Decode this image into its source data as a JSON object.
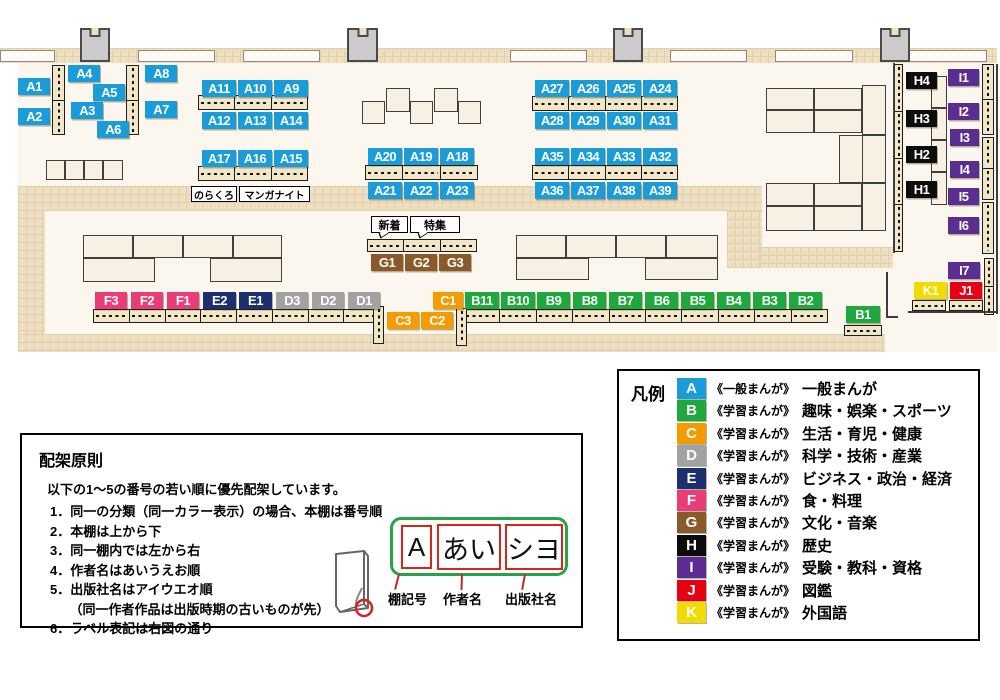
{
  "palette": {
    "A": "#1a9cd8",
    "B": "#1fa83d",
    "C": "#f49b00",
    "D": "#a2a2a2",
    "E": "#1c2f6e",
    "F": "#e83d77",
    "G": "#8b5a2b",
    "H": "#0c0c0c",
    "I": "#5c2d91",
    "J": "#e60012",
    "K": "#f2dc00",
    "label_text": "#ffffff"
  },
  "map": {
    "shelf_labels": [
      {
        "id": "A1",
        "x": 18,
        "y": 78,
        "w": 32
      },
      {
        "id": "A2",
        "x": 18,
        "y": 108,
        "w": 32
      },
      {
        "id": "A3",
        "x": 71,
        "y": 102,
        "w": 32
      },
      {
        "id": "A4",
        "x": 68,
        "y": 65,
        "w": 32
      },
      {
        "id": "A5",
        "x": 93,
        "y": 84,
        "w": 32
      },
      {
        "id": "A6",
        "x": 97,
        "y": 121,
        "w": 32
      },
      {
        "id": "A7",
        "x": 145,
        "y": 101,
        "w": 32
      },
      {
        "id": "A8",
        "x": 145,
        "y": 65,
        "w": 32
      },
      {
        "id": "A9",
        "x": 274,
        "y": 80,
        "w": 34
      },
      {
        "id": "A10",
        "x": 238,
        "y": 80,
        "w": 34
      },
      {
        "id": "A11",
        "x": 202,
        "y": 80,
        "w": 34
      },
      {
        "id": "A12",
        "x": 202,
        "y": 112,
        "w": 34
      },
      {
        "id": "A13",
        "x": 238,
        "y": 112,
        "w": 34
      },
      {
        "id": "A14",
        "x": 274,
        "y": 112,
        "w": 34
      },
      {
        "id": "A15",
        "x": 274,
        "y": 150,
        "w": 34
      },
      {
        "id": "A16",
        "x": 238,
        "y": 150,
        "w": 34
      },
      {
        "id": "A17",
        "x": 202,
        "y": 150,
        "w": 34
      },
      {
        "id": "A18",
        "x": 440,
        "y": 148,
        "w": 34
      },
      {
        "id": "A19",
        "x": 404,
        "y": 148,
        "w": 34
      },
      {
        "id": "A20",
        "x": 368,
        "y": 148,
        "w": 34
      },
      {
        "id": "A21",
        "x": 368,
        "y": 182,
        "w": 34
      },
      {
        "id": "A22",
        "x": 404,
        "y": 182,
        "w": 34
      },
      {
        "id": "A23",
        "x": 440,
        "y": 182,
        "w": 34
      },
      {
        "id": "A24",
        "x": 643,
        "y": 80,
        "w": 34
      },
      {
        "id": "A25",
        "x": 607,
        "y": 80,
        "w": 34
      },
      {
        "id": "A26",
        "x": 571,
        "y": 80,
        "w": 34
      },
      {
        "id": "A27",
        "x": 535,
        "y": 80,
        "w": 34
      },
      {
        "id": "A28",
        "x": 535,
        "y": 112,
        "w": 34
      },
      {
        "id": "A29",
        "x": 571,
        "y": 112,
        "w": 34
      },
      {
        "id": "A30",
        "x": 607,
        "y": 112,
        "w": 34
      },
      {
        "id": "A31",
        "x": 643,
        "y": 112,
        "w": 34
      },
      {
        "id": "A32",
        "x": 643,
        "y": 148,
        "w": 34
      },
      {
        "id": "A33",
        "x": 607,
        "y": 148,
        "w": 34
      },
      {
        "id": "A34",
        "x": 571,
        "y": 148,
        "w": 34
      },
      {
        "id": "A35",
        "x": 535,
        "y": 148,
        "w": 34
      },
      {
        "id": "A36",
        "x": 535,
        "y": 182,
        "w": 34
      },
      {
        "id": "A37",
        "x": 571,
        "y": 182,
        "w": 34
      },
      {
        "id": "A38",
        "x": 607,
        "y": 182,
        "w": 34
      },
      {
        "id": "A39",
        "x": 643,
        "y": 182,
        "w": 34
      },
      {
        "id": "B1",
        "x": 846,
        "y": 306,
        "w": 34
      },
      {
        "id": "B2",
        "x": 789,
        "y": 292,
        "w": 33
      },
      {
        "id": "B3",
        "x": 753,
        "y": 292,
        "w": 33
      },
      {
        "id": "B4",
        "x": 717,
        "y": 292,
        "w": 33
      },
      {
        "id": "B5",
        "x": 681,
        "y": 292,
        "w": 33
      },
      {
        "id": "B6",
        "x": 645,
        "y": 292,
        "w": 33
      },
      {
        "id": "B7",
        "x": 609,
        "y": 292,
        "w": 33
      },
      {
        "id": "B8",
        "x": 573,
        "y": 292,
        "w": 33
      },
      {
        "id": "B9",
        "x": 537,
        "y": 292,
        "w": 33
      },
      {
        "id": "B10",
        "x": 501,
        "y": 292,
        "w": 34
      },
      {
        "id": "B11",
        "x": 465,
        "y": 292,
        "w": 34
      },
      {
        "id": "C1",
        "x": 433,
        "y": 292,
        "w": 30
      },
      {
        "id": "C2",
        "x": 421,
        "y": 312,
        "w": 32
      },
      {
        "id": "C3",
        "x": 387,
        "y": 312,
        "w": 32
      },
      {
        "id": "D1",
        "x": 348,
        "y": 292,
        "w": 32
      },
      {
        "id": "D2",
        "x": 312,
        "y": 292,
        "w": 32
      },
      {
        "id": "D3",
        "x": 276,
        "y": 292,
        "w": 32
      },
      {
        "id": "E1",
        "x": 239,
        "y": 292,
        "w": 33
      },
      {
        "id": "E2",
        "x": 203,
        "y": 292,
        "w": 33
      },
      {
        "id": "F1",
        "x": 167,
        "y": 292,
        "w": 32
      },
      {
        "id": "F2",
        "x": 131,
        "y": 292,
        "w": 32
      },
      {
        "id": "F3",
        "x": 95,
        "y": 292,
        "w": 32
      },
      {
        "id": "G1",
        "x": 371,
        "y": 254,
        "w": 32
      },
      {
        "id": "G2",
        "x": 405,
        "y": 254,
        "w": 32
      },
      {
        "id": "G3",
        "x": 439,
        "y": 254,
        "w": 32
      },
      {
        "id": "H1",
        "x": 906,
        "y": 181,
        "w": 31
      },
      {
        "id": "H2",
        "x": 906,
        "y": 146,
        "w": 31
      },
      {
        "id": "H3",
        "x": 906,
        "y": 110,
        "w": 31
      },
      {
        "id": "H4",
        "x": 906,
        "y": 72,
        "w": 31
      },
      {
        "id": "I1",
        "x": 948,
        "y": 69,
        "w": 31
      },
      {
        "id": "I2",
        "x": 948,
        "y": 103,
        "w": 31
      },
      {
        "id": "I3",
        "x": 950,
        "y": 129,
        "w": 29
      },
      {
        "id": "I4",
        "x": 950,
        "y": 161,
        "w": 29
      },
      {
        "id": "I5",
        "x": 948,
        "y": 188,
        "w": 31
      },
      {
        "id": "I6",
        "x": 948,
        "y": 217,
        "w": 31
      },
      {
        "id": "I7",
        "x": 948,
        "y": 262,
        "w": 32
      },
      {
        "id": "J1",
        "x": 950,
        "y": 282,
        "w": 32
      },
      {
        "id": "K1",
        "x": 914,
        "y": 282,
        "w": 33
      }
    ],
    "annotations": [
      {
        "id": "norakuro",
        "text": "のらくろ",
        "x": 191,
        "y": 186,
        "w": 46,
        "h": 16,
        "fs": 10
      },
      {
        "id": "manga-night",
        "text": "マンガナイト",
        "x": 239,
        "y": 186,
        "w": 71,
        "h": 16,
        "fs": 10
      },
      {
        "id": "new-arrivals",
        "text": "新着",
        "x": 371,
        "y": 216,
        "w": 37,
        "h": 17,
        "fs": 11,
        "tail": true
      },
      {
        "id": "special-feature",
        "text": "特集",
        "x": 410,
        "y": 216,
        "w": 50,
        "h": 17,
        "fs": 11,
        "tail": true
      }
    ]
  },
  "legend": {
    "title": "凡例",
    "entries": [
      {
        "letter": "A",
        "type": "《一般まんが》",
        "category": "一般まんが"
      },
      {
        "letter": "B",
        "type": "《学習まんが》",
        "category": "趣味・娯楽・スポーツ"
      },
      {
        "letter": "C",
        "type": "《学習まんが》",
        "category": "生活・育児・健康"
      },
      {
        "letter": "D",
        "type": "《学習まんが》",
        "category": "科学・技術・産業"
      },
      {
        "letter": "E",
        "type": "《学習まんが》",
        "category": "ビジネス・政治・経済"
      },
      {
        "letter": "F",
        "type": "《学習まんが》",
        "category": "食・料理"
      },
      {
        "letter": "G",
        "type": "《学習まんが》",
        "category": "文化・音楽"
      },
      {
        "letter": "H",
        "type": "《学習まんが》",
        "category": "歴史"
      },
      {
        "letter": "I",
        "type": "《学習まんが》",
        "category": "受験・教科・資格"
      },
      {
        "letter": "J",
        "type": "《学習まんが》",
        "category": "図鑑"
      },
      {
        "letter": "K",
        "type": "《学習まんが》",
        "category": "外国語"
      }
    ]
  },
  "principles": {
    "title": "配架原則",
    "intro": "以下の1～5の番号の若い順に優先配架しています。",
    "items": [
      "1．同一の分類（同一カラー表示）の場合、本棚は番号順",
      "2．本棚は上から下",
      "3．同一棚内では左から右",
      "4．作者名はあいうえお順",
      "5．出版社名はアイウエオ順",
      "　　（同一作者作品は出版時期の古いものが先）",
      "6．ラベル表記は右図の通り"
    ]
  },
  "spine_label": {
    "parts": [
      "A",
      "あい",
      "シヨ"
    ],
    "callouts": [
      "棚記号",
      "作者名",
      "出版社名"
    ]
  }
}
